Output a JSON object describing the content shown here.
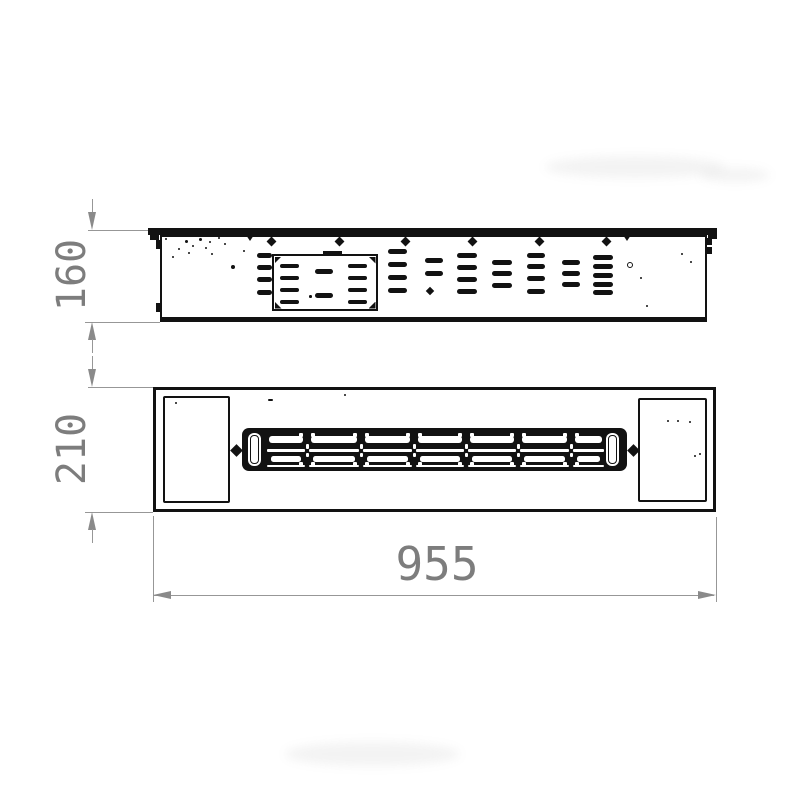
{
  "dimensions": {
    "height_side": {
      "label": "160"
    },
    "height_top": {
      "label": "210"
    },
    "width": {
      "label": "955"
    }
  },
  "colors": {
    "line": "#121212",
    "dim_line": "#979797",
    "dim_arrow": "#8a8a8a",
    "dim_text": "#7d7d7d",
    "background": "#ffffff"
  },
  "figure": {
    "side_view": {
      "slot_h": 4.5,
      "outside_column": {
        "x": 257,
        "w": 15,
        "ys": [
          253,
          265,
          277,
          290
        ]
      },
      "plate_columns": [
        {
          "x": 280,
          "w": 19
        },
        {
          "x": 348,
          "w": 19
        }
      ],
      "plate_rows": [
        263.5,
        275.5,
        287.5,
        299.5
      ],
      "plate_middles": {
        "x": 315,
        "w": 18,
        "h": 5,
        "ys": [
          268.5,
          292.5
        ]
      },
      "plate_dot": [
        309,
        295,
        2.5
      ],
      "vent_columns": [
        {
          "x": 388,
          "w": 19,
          "ys": [
            249,
            262,
            275,
            288
          ]
        },
        {
          "x": 425,
          "w": 18,
          "ys": [
            258,
            271
          ]
        },
        {
          "x": 457,
          "w": 20,
          "ys": [
            253,
            265,
            277,
            289
          ]
        },
        {
          "x": 492,
          "w": 20,
          "ys": [
            260,
            271,
            283
          ]
        },
        {
          "x": 527,
          "w": 18,
          "ys": [
            253,
            264,
            276,
            289
          ]
        },
        {
          "x": 562,
          "w": 18,
          "ys": [
            260,
            271,
            282
          ]
        },
        {
          "x": 593,
          "w": 20,
          "ys": [
            255,
            264,
            273,
            282,
            290
          ]
        }
      ],
      "screw_xs": [
        271,
        339,
        405,
        472,
        539,
        606
      ],
      "screw_y": 237.5,
      "hanger_xs": [
        250,
        627
      ],
      "diamond_dot": [
        427,
        288,
        6
      ],
      "ring_dot": [
        627,
        262,
        6
      ],
      "speckles": [
        [
          165,
          238,
          2
        ],
        [
          172,
          256,
          2
        ],
        [
          178,
          248,
          2
        ],
        [
          185,
          240,
          3
        ],
        [
          192,
          245,
          2
        ],
        [
          199,
          238,
          3
        ],
        [
          205,
          247,
          2
        ],
        [
          211,
          253,
          2
        ],
        [
          218,
          237,
          2
        ],
        [
          224,
          243,
          2
        ],
        [
          231,
          265,
          4
        ],
        [
          243,
          250,
          2
        ],
        [
          188,
          252,
          2
        ],
        [
          209,
          241,
          2
        ],
        [
          640,
          277,
          2
        ],
        [
          681,
          253,
          2
        ],
        [
          690,
          261,
          2
        ],
        [
          646,
          305,
          2
        ]
      ]
    },
    "front_view": {
      "cell_bounds": [
        265,
        307,
        361,
        414,
        466,
        518,
        571,
        606
      ],
      "dots": [
        [
          667,
          420,
          2
        ],
        [
          677,
          420,
          2
        ],
        [
          689,
          421,
          2
        ],
        [
          694,
          455,
          2
        ],
        [
          699,
          453,
          2
        ],
        [
          175,
          402,
          2
        ],
        [
          344,
          394,
          2
        ]
      ],
      "tick": [
        268,
        399,
        5,
        2
      ]
    }
  }
}
